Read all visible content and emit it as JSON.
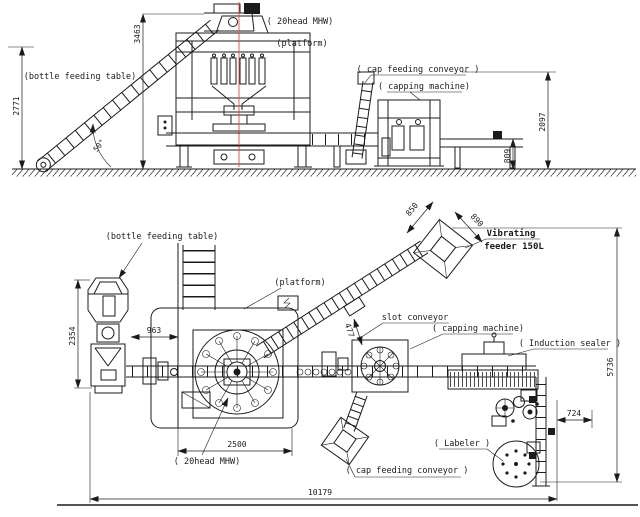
{
  "drawing": {
    "colors": {
      "line": "#1b1b1b",
      "centerline": "#e0503c",
      "background": "#ffffff"
    },
    "top": {
      "labels": {
        "bft": "(bottle feeding table)",
        "head20": "( 20head MHW)",
        "platform": "(platform)",
        "cap_conveyor": "( cap feeding conveyor )",
        "capping": "( capping machine)"
      },
      "dims": {
        "h2771": "2771",
        "h3463": "3463",
        "h2097": "2097",
        "h809": "809",
        "angle": "50°"
      }
    },
    "plan": {
      "labels": {
        "bft": "(bottle feeding table)",
        "platform": "(platform)",
        "head20": "( 20head MHW)",
        "slot": "slot conveyor",
        "vib1": "Vibrating",
        "vib2": "feeder 150L",
        "capping": "( capping machine)",
        "cap_conveyor": "( cap feeding conveyor )",
        "sealer": "( Induction sealer )",
        "labeler": "( Labeler )"
      },
      "dims": {
        "d2354": "2354",
        "d963": "963",
        "d2500": "2500",
        "d477": "477",
        "d850": "850",
        "d890": "890",
        "d724": "724",
        "d5736": "5736",
        "d10179": "10179"
      }
    }
  }
}
